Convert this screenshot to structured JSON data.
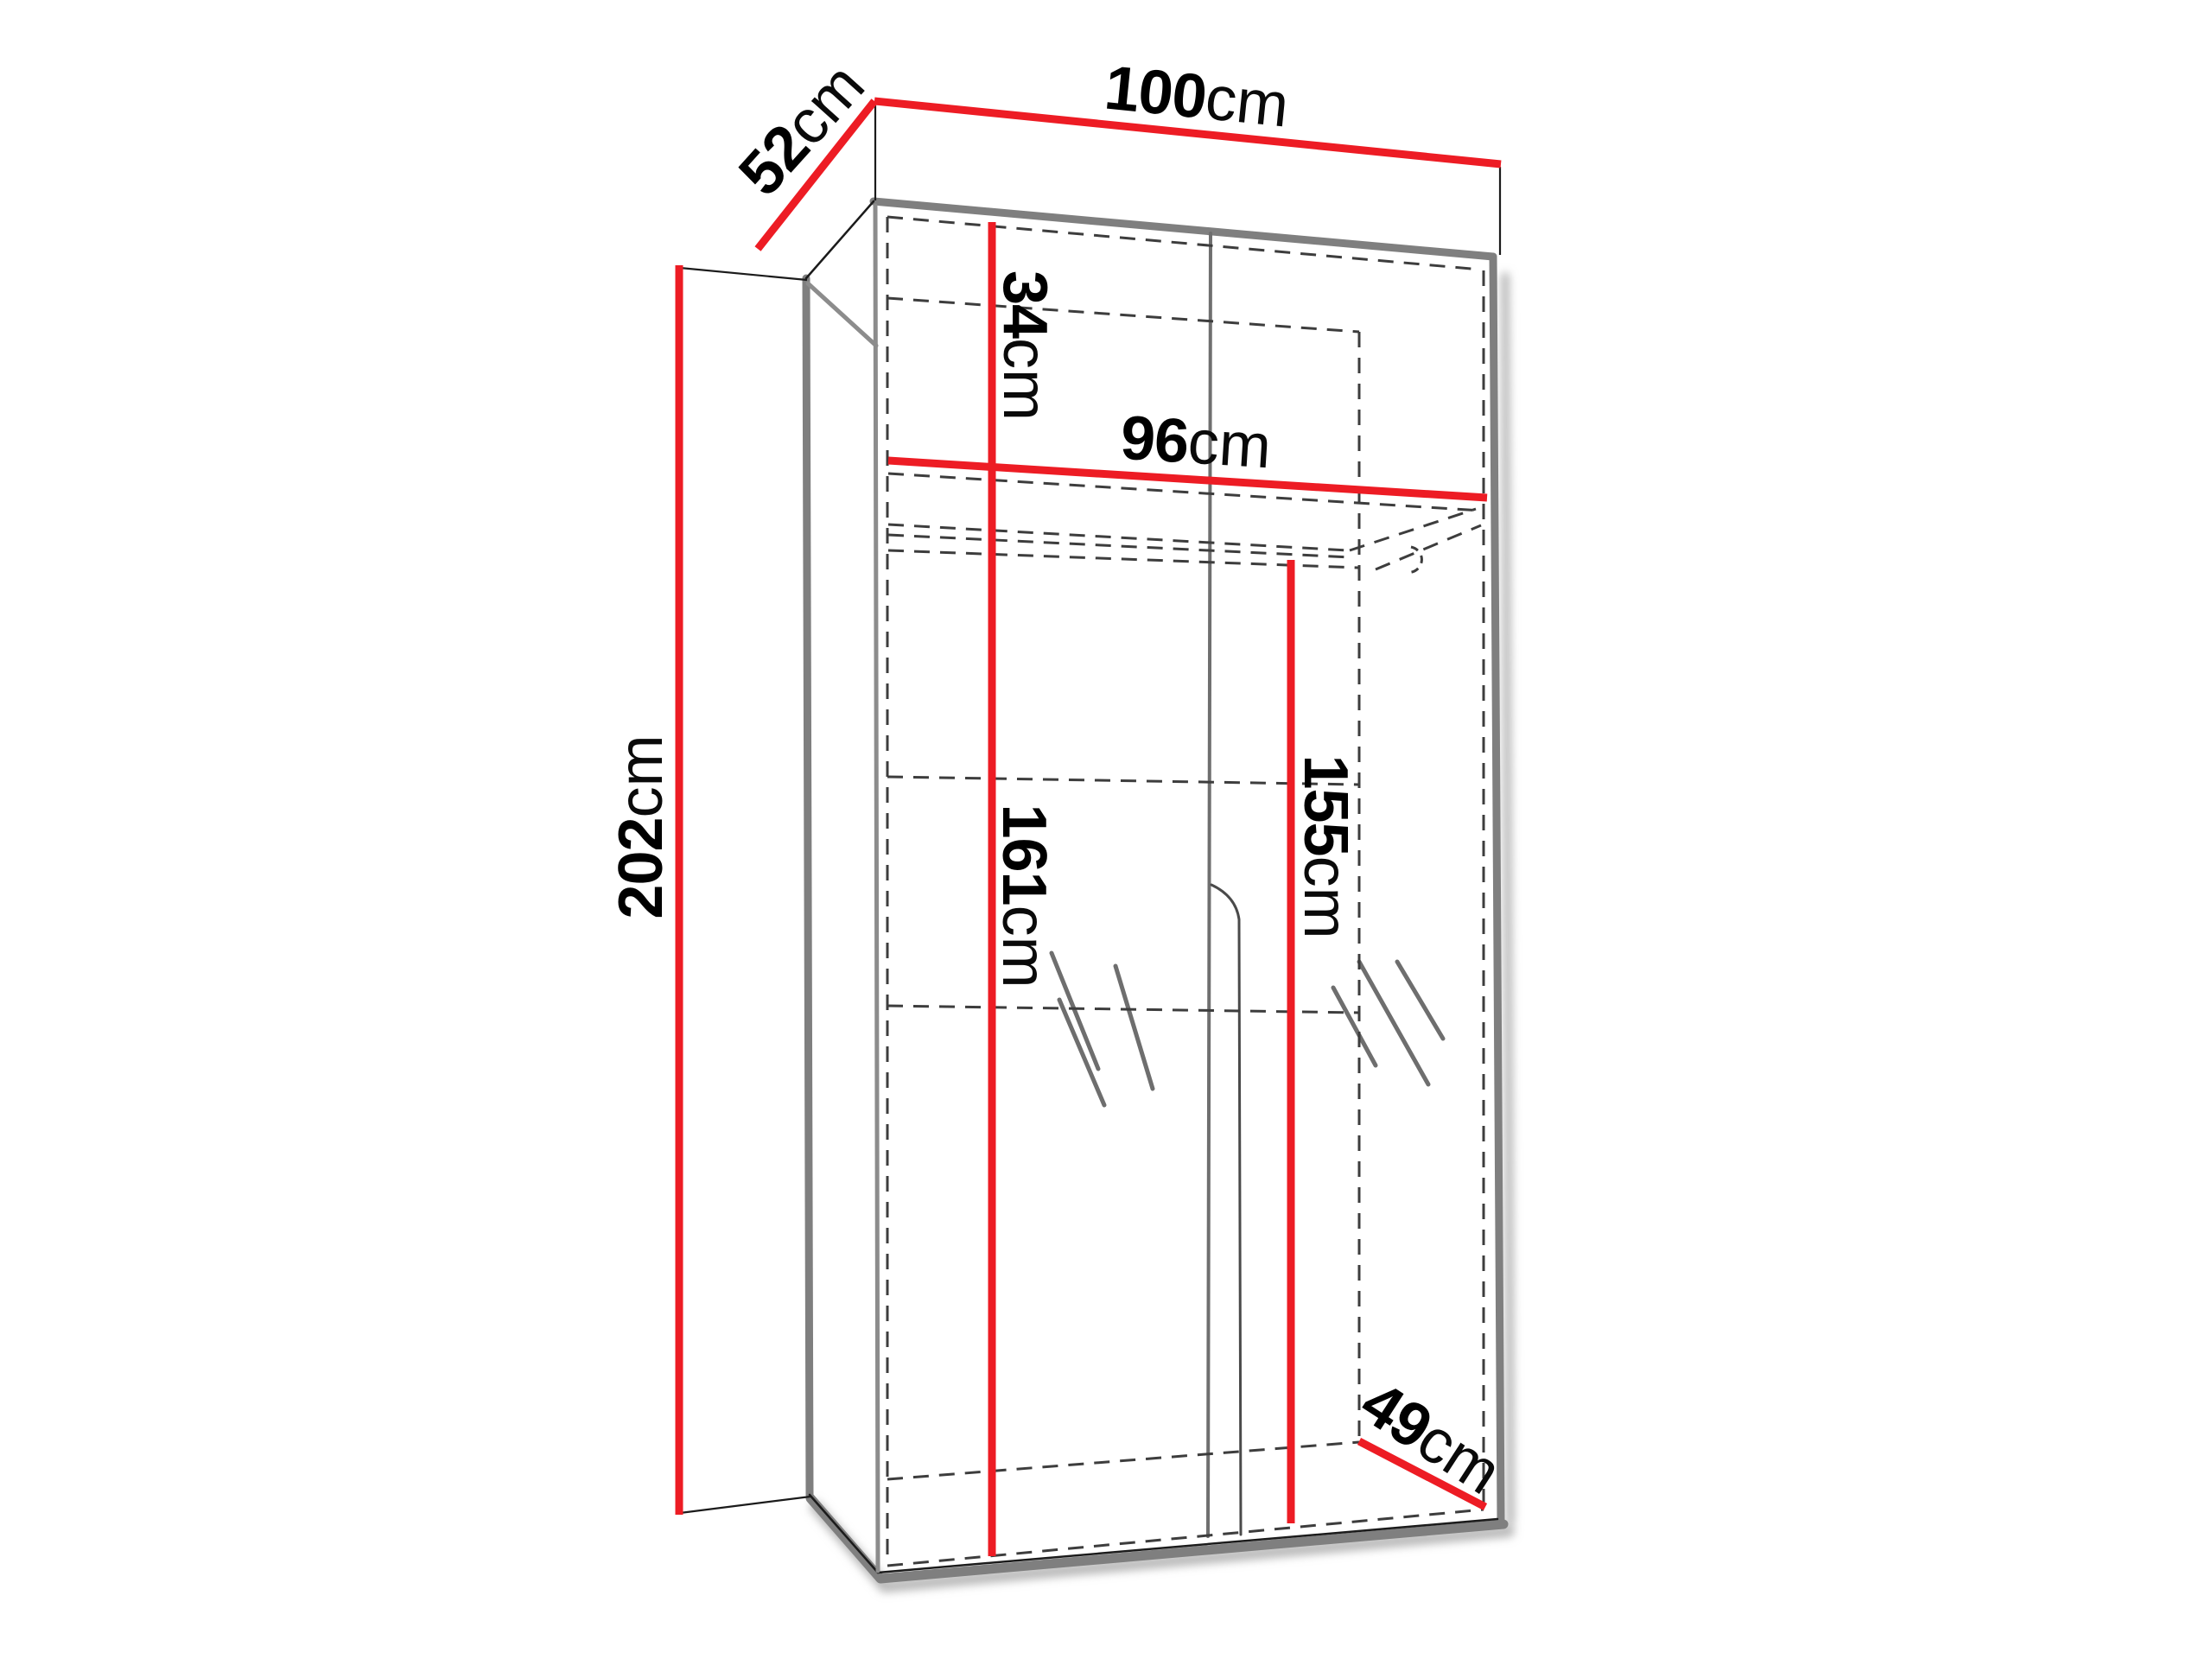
{
  "diagram": {
    "title": "Two-door wardrobe dimension diagram",
    "unit": "cm",
    "dimensions": {
      "top_width": {
        "value": "100",
        "unit": "cm"
      },
      "top_depth": {
        "value": "52",
        "unit": "cm"
      },
      "height": {
        "value": "202",
        "unit": "cm"
      },
      "top_compartment_height": {
        "value": "34",
        "unit": "cm"
      },
      "interior_width": {
        "value": "96",
        "unit": "cm"
      },
      "left_interior_height": {
        "value": "161",
        "unit": "cm"
      },
      "right_interior_height": {
        "value": "155",
        "unit": "cm"
      },
      "bottom_depth": {
        "value": "49",
        "unit": "cm"
      }
    },
    "colors": {
      "dimension_line": "#ed1c24",
      "outline": "#7f7f7f",
      "hidden_edge": "#3d3d3d",
      "edge_dark": "#1b1b1b",
      "background": "#ffffff"
    }
  }
}
